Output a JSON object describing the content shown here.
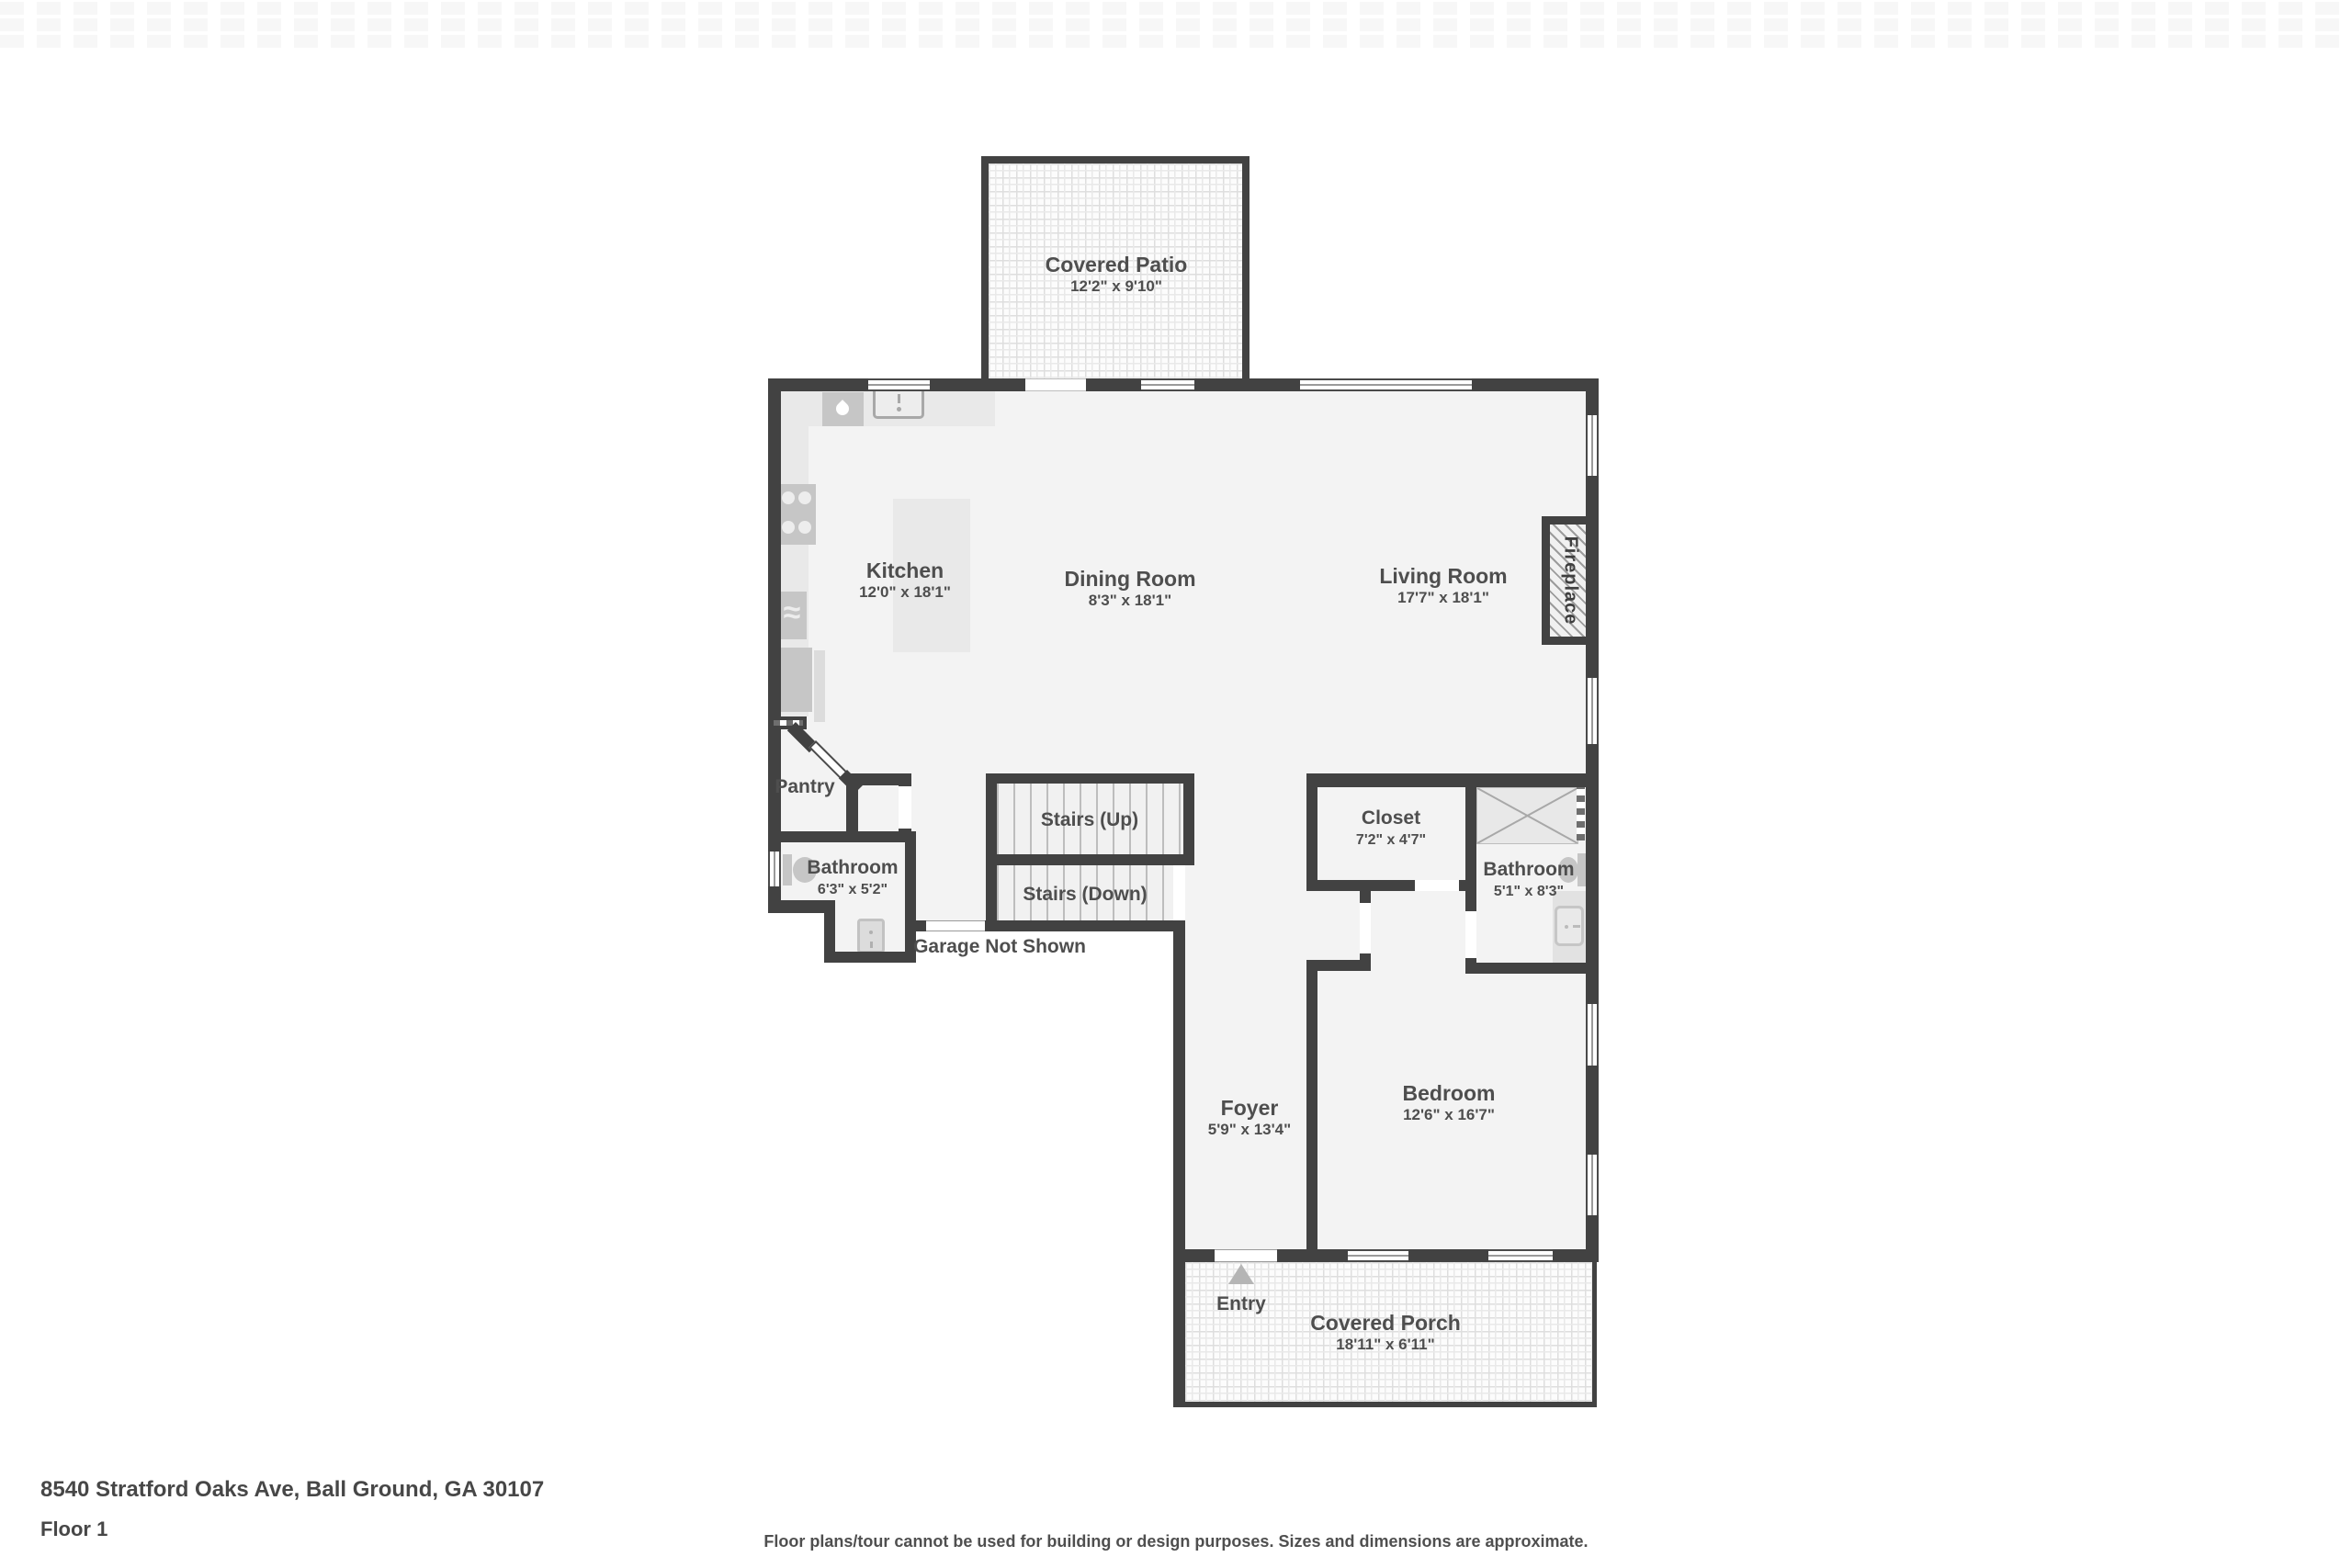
{
  "rooms": {
    "covered_patio": {
      "label": "Covered Patio",
      "dims": "12'2\" x 9'10\""
    },
    "kitchen": {
      "label": "Kitchen",
      "dims": "12'0\" x 18'1\""
    },
    "dining_room": {
      "label": "Dining Room",
      "dims": "8'3\" x 18'1\""
    },
    "living_room": {
      "label": "Living Room",
      "dims": "17'7\" x 18'1\""
    },
    "fireplace": {
      "label": "Fireplace"
    },
    "pantry": {
      "label": "Pantry"
    },
    "bathroom_1": {
      "label": "Bathroom",
      "dims": "6'3\" x 5'2\""
    },
    "stairs_up": {
      "label": "Stairs (Up)"
    },
    "stairs_down": {
      "label": "Stairs (Down)"
    },
    "garage_note": {
      "label": "Garage Not Shown"
    },
    "closet": {
      "label": "Closet",
      "dims": "7'2\" x 4'7\""
    },
    "bathroom_2": {
      "label": "Bathroom",
      "dims": "5'1\" x 8'3\""
    },
    "foyer": {
      "label": "Foyer",
      "dims": "5'9\" x 13'4\""
    },
    "bedroom": {
      "label": "Bedroom",
      "dims": "12'6\" x 16'7\""
    },
    "entry": {
      "label": "Entry"
    },
    "covered_porch": {
      "label": "Covered Porch",
      "dims": "18'11\" x 6'11\""
    }
  },
  "icons": {
    "oven_wave_glyph": "≈",
    "names": [
      "sink-icon",
      "dishwasher-droplet-icon",
      "stove-burners-icon",
      "oven-icon",
      "fridge-icon",
      "toilet-icon",
      "shower-icon",
      "vanity-sink-icon",
      "water-heater-icon",
      "entry-arrow-icon"
    ]
  },
  "footer": {
    "address": "8540 Stratford Oaks Ave, Ball Ground, GA 30107",
    "floor": "Floor 1",
    "disclaimer": "Floor plans/tour cannot be used for building or design purposes. Sizes and dimensions are approximate."
  },
  "colors": {
    "wall": "#424242",
    "floor": "#f3f3f3",
    "fixture": "#c6c6c6",
    "counter": "#e9e9e9",
    "text": "#4e4e4e"
  }
}
